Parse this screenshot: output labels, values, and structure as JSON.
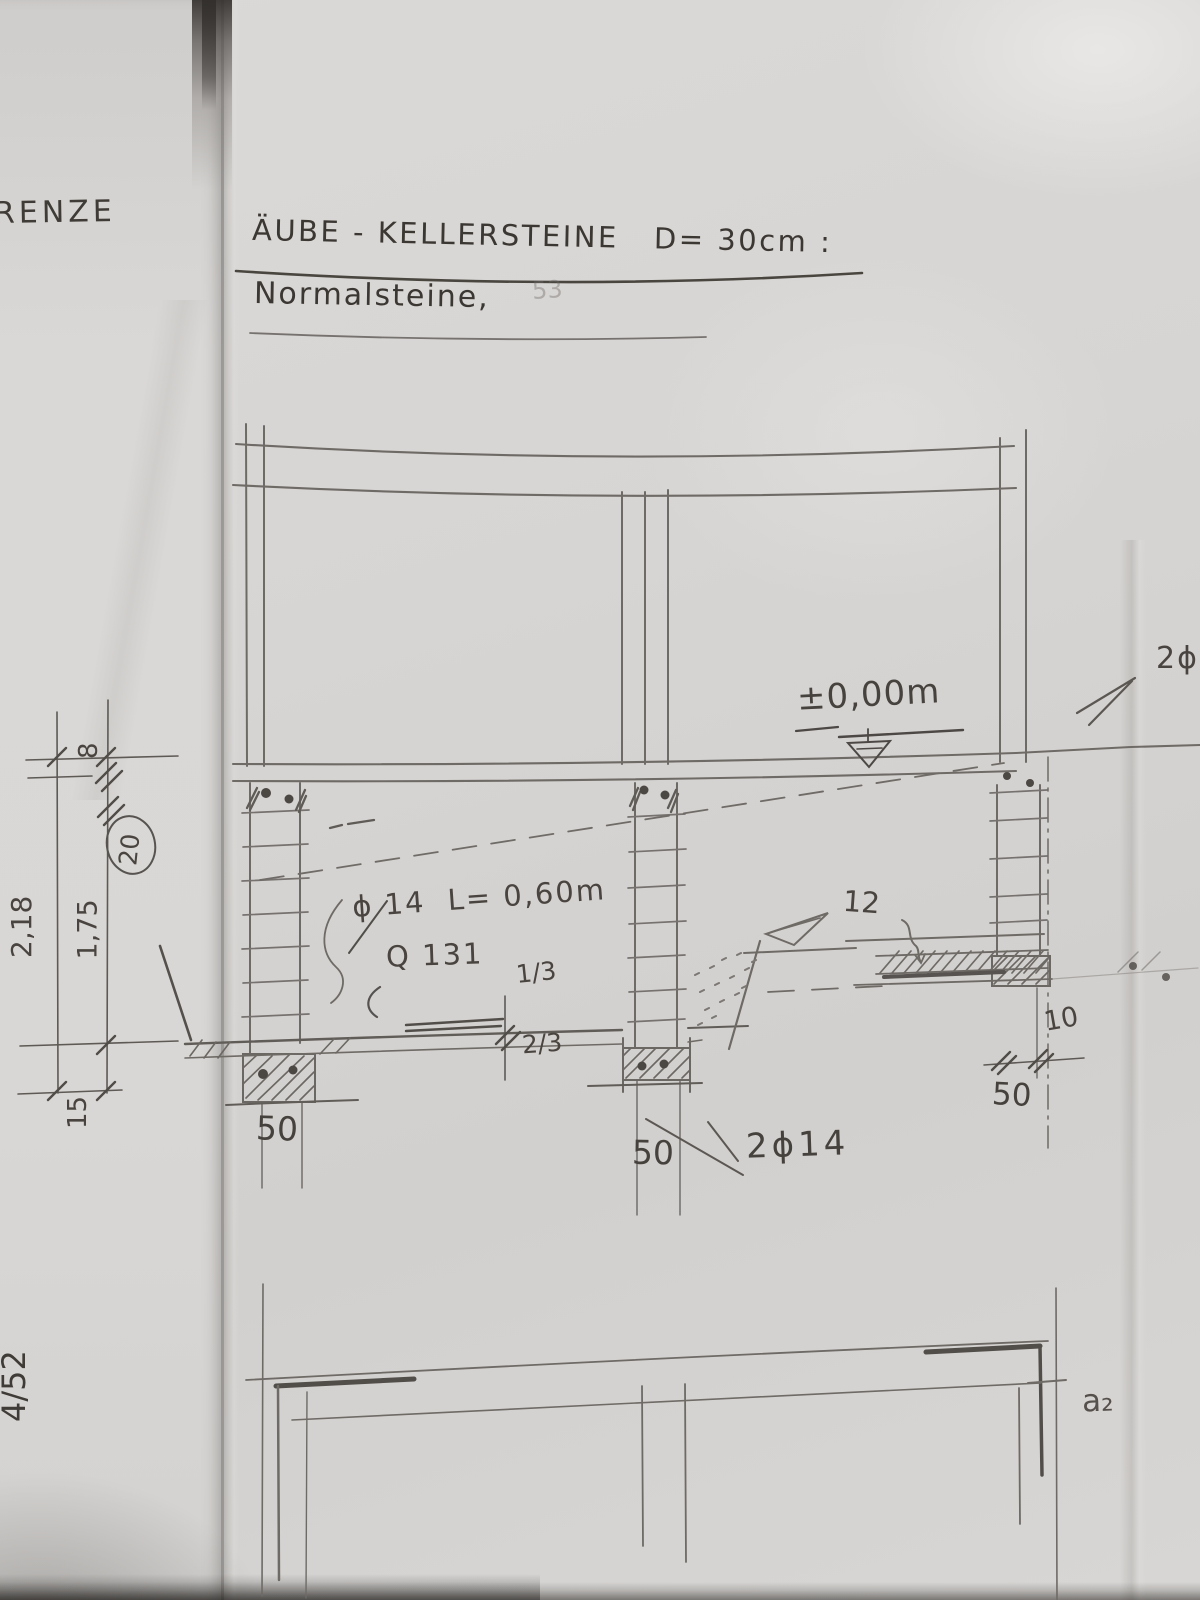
{
  "sheet": {
    "margin_note": "RENZE",
    "corner_note": "4/52",
    "detail_mark": "a₂",
    "faint_mark": "53"
  },
  "title": {
    "line1": "ÄUBE - KELLERSTEINE   D= 30cm :",
    "line2": "Normalsteine,"
  },
  "levels": {
    "zero": "±0,00m"
  },
  "notes": {
    "rebar": "ϕ 14  L= 0,60m",
    "mesh": "Q 131",
    "bottom_rebar": "2ϕ14",
    "edge_rebar": "2ϕ",
    "slab_thickness": "12"
  },
  "fractions": {
    "top": "1/3",
    "bottom": "2/3"
  },
  "widths": {
    "left": "50",
    "middle": "50",
    "right": "50",
    "offset": "10"
  },
  "dims_left": {
    "overall": "2,18",
    "inner": "1,75",
    "footing": "15",
    "circled": "20",
    "top": "8"
  }
}
